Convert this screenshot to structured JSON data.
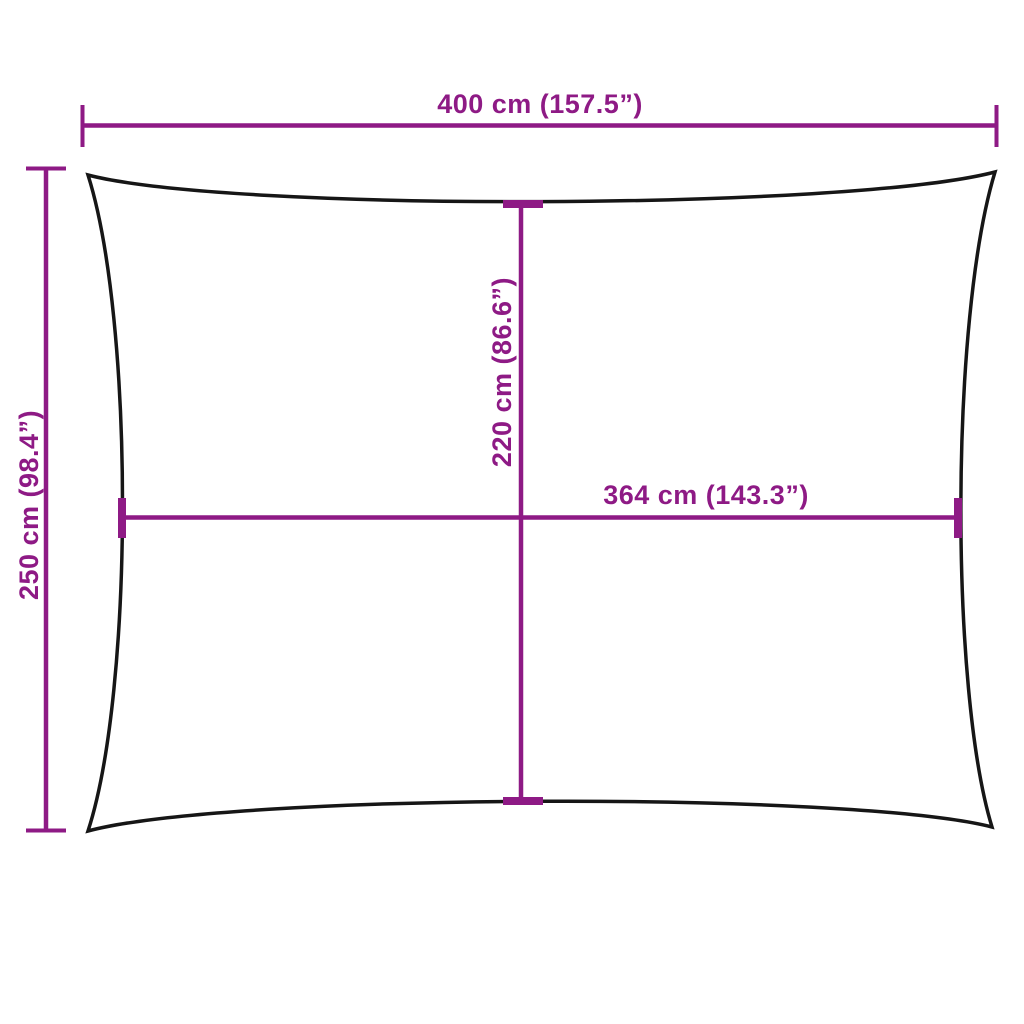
{
  "colors": {
    "dimension": "#8E1A85",
    "outline": "#161616",
    "background": "#ffffff"
  },
  "diagram": {
    "type": "product-dimension-diagram",
    "shape": "rectangular sail with concave edges"
  },
  "dimensions": {
    "top_width": {
      "label": "400 cm (157.5”)",
      "value_cm": 400,
      "value_inches": 157.5
    },
    "left_height": {
      "label": "250 cm (98.4”)",
      "value_cm": 250,
      "value_inches": 98.4
    },
    "center_height": {
      "label": "220 cm (86.6”)",
      "value_cm": 220,
      "value_inches": 86.6
    },
    "center_width": {
      "label": "364 cm (143.3”)",
      "value_cm": 364,
      "value_inches": 143.3
    }
  }
}
